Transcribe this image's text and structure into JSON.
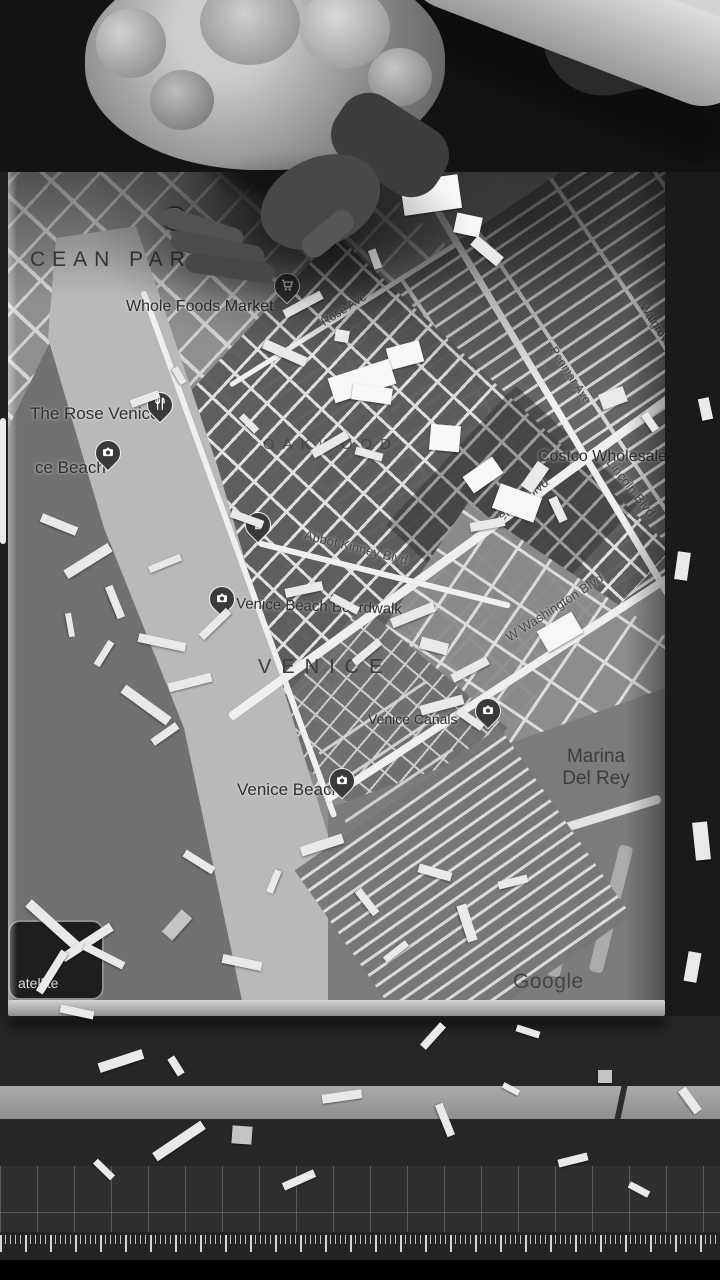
{
  "map": {
    "area_labels": {
      "ocean_park": "CEAN PARK",
      "oakwood": "OAKWOOD",
      "venice": "VENICE",
      "marina_line1": "Marina",
      "marina_line2": "Del Rey"
    },
    "poi": {
      "whole_foods": "Whole Foods Market",
      "rose_venice": "The Rose Venice",
      "venice_beach_truncated": "ce Beach",
      "costco": "Costco Wholesale",
      "boardwalk": "Venice Beach Boardwalk",
      "canals": "Venice Canals",
      "venice_beach_south": "Venice Beach"
    },
    "streets": {
      "rose_ave": "Rose Ave",
      "penmar_ave": "Penmar Ave",
      "walgrove_ave": "Walgrove Ave",
      "beethoven_st": "Beethoven St",
      "lincoln_blvd": "Lincoln Blvd",
      "venice_blvd": "Venice Blvd",
      "abbot_kinney": "Abbot Kinney Blvd",
      "washington_blvd": "W Washington Blvd"
    },
    "route_shield": "1",
    "watermark": "Google",
    "controls": {
      "satellite_label": "atellite"
    },
    "icons": {
      "grocery": "cart-pin-icon",
      "restaurant": "restaurant-pin-icon",
      "attraction": "camera-pin-icon",
      "store": "shopping-bag-pin-icon"
    },
    "colors": {
      "map_base": "#8f8f8f",
      "streets": "#e4e4e4",
      "dark_blocks": "#5c5c5c",
      "sand": "#b9b9b9",
      "ocean": "#717171",
      "label_text": "#2f2f2f",
      "pin_body": "#3a3a3a"
    }
  }
}
